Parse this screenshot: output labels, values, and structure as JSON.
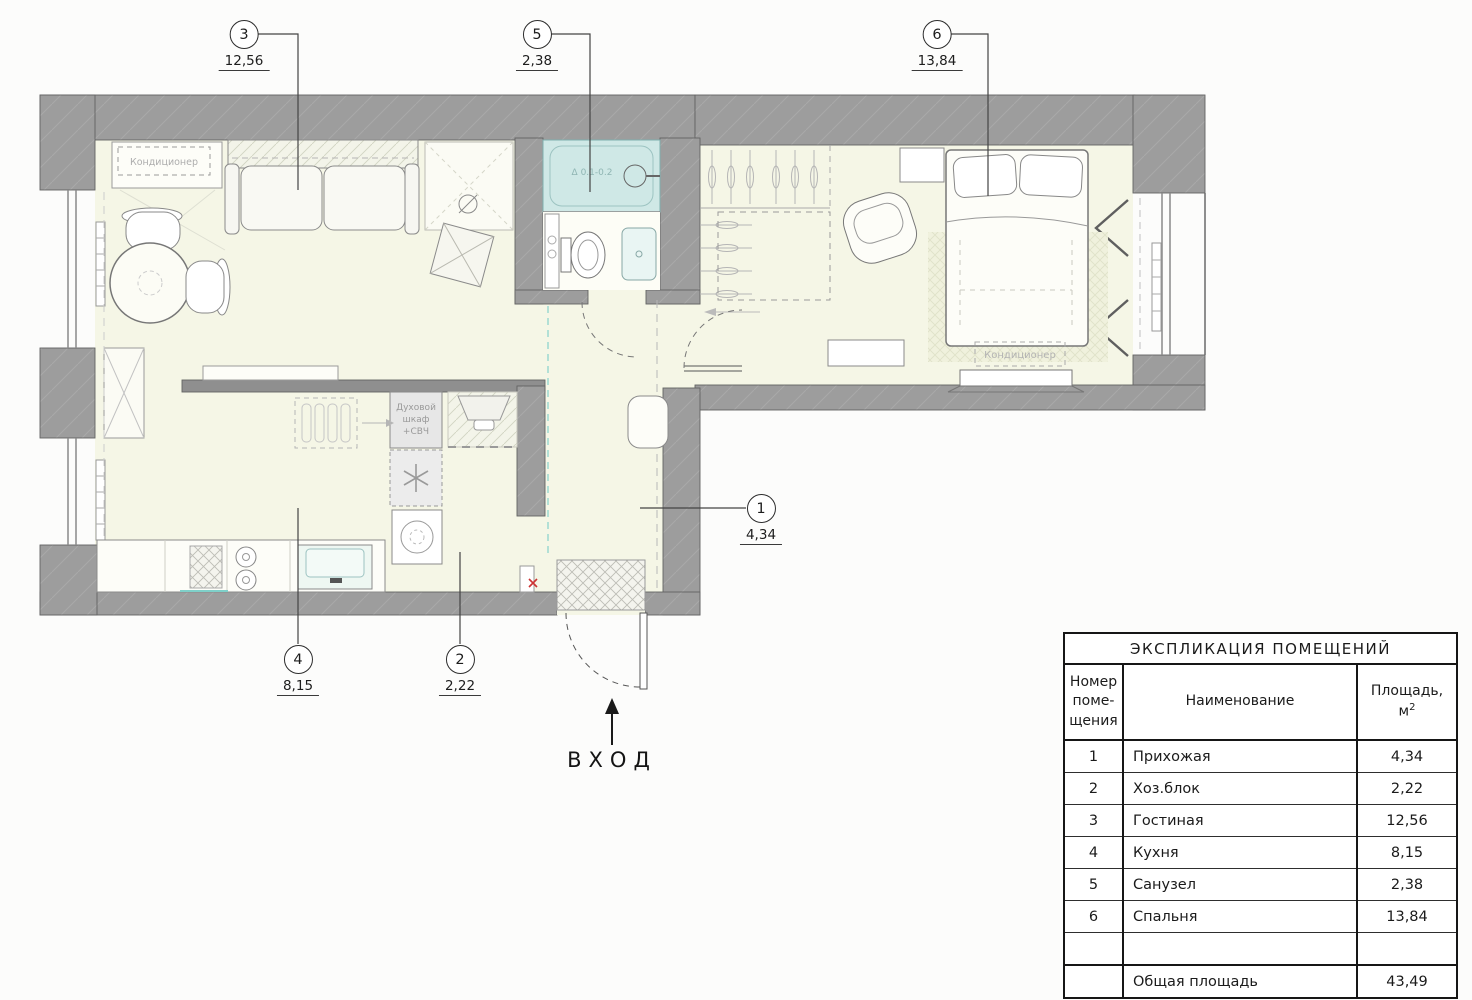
{
  "plan": {
    "entrance": {
      "label": "ВХОД"
    },
    "labels": {
      "ac_living": "Кондиционер",
      "ac_bedroom": "Кондиционер",
      "oven_line1": "Духовой",
      "oven_line2": "шкаф",
      "oven_line3": "+СВЧ",
      "bath_level_mark": "Δ 0.1-0.2"
    },
    "callouts": [
      {
        "num": "3",
        "value": "12,56"
      },
      {
        "num": "5",
        "value": "2,38"
      },
      {
        "num": "6",
        "value": "13,84"
      },
      {
        "num": "1",
        "value": "4,34"
      },
      {
        "num": "4",
        "value": "8,15"
      },
      {
        "num": "2",
        "value": "2,22"
      }
    ]
  },
  "legend_table": {
    "title": "ЭКСПЛИКАЦИЯ ПОМЕЩЕНИЙ",
    "headers": {
      "number_lines": [
        "Номер",
        "поме-",
        "щения"
      ],
      "name": "Наименование",
      "area_line1": "Площадь,",
      "area_unit": "м",
      "area_sup": "2"
    },
    "rows": [
      {
        "num": "1",
        "name": "Прихожая",
        "area": "4,34"
      },
      {
        "num": "2",
        "name": "Хоз.блок",
        "area": "2,22"
      },
      {
        "num": "3",
        "name": "Гостиная",
        "area": "12,56"
      },
      {
        "num": "4",
        "name": "Кухня",
        "area": "8,15"
      },
      {
        "num": "5",
        "name": "Санузел",
        "area": "2,38"
      },
      {
        "num": "6",
        "name": "Спальня",
        "area": "13,84"
      }
    ],
    "total": {
      "label": "Общая площадь",
      "value": "43,49"
    }
  },
  "colors": {
    "wall": "#9d9d9d",
    "floor": "#f5f6e6",
    "bath": "#cfe8e6",
    "accent_teal": "#7fd0c9",
    "line": "#4f4f4f",
    "red_mark": "#cc3333"
  }
}
